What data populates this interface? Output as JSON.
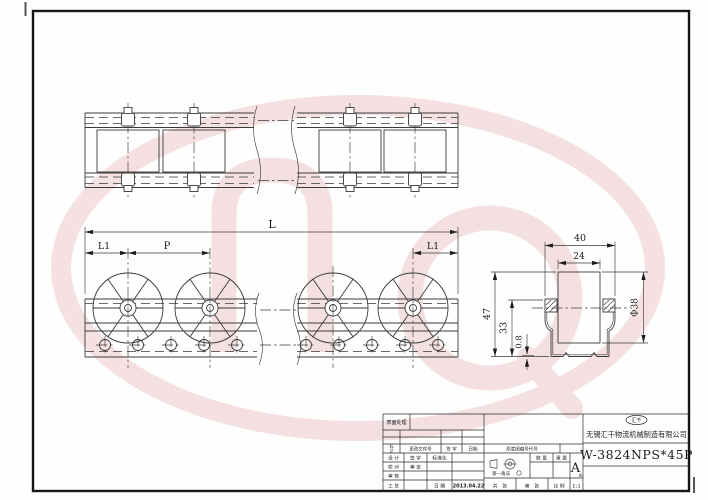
{
  "dims": {
    "L": "L",
    "L1_left": "L1",
    "P": "P",
    "L1_right": "L1",
    "outer_width": "40",
    "inner_width": "24",
    "total_height": "47",
    "rail_height": "33",
    "thickness": "0.8",
    "wheel_dia": "Φ38"
  },
  "title_block": {
    "surface": "表面处理",
    "mark_top": "标",
    "mark_bottom": "记",
    "change_doc": "更改文件号",
    "sign": "签 字",
    "date_h": "日期",
    "r1c1": "设 计",
    "r1c2": "签 字",
    "r1c3": "标准化",
    "r2c1": "校 对",
    "r2c2": "审 定",
    "r3c1": "审 核",
    "r4c1": "工 艺",
    "r4c3": "日 期",
    "date_value": "2013.04.22",
    "base_no": "原底图编号代号",
    "projection": "第一角法",
    "qty": "数 量",
    "weight": "重 量",
    "size_letter": "A",
    "size_sub": "张",
    "sheet_total": "共　张",
    "sheet_no": "第　张",
    "scale_label": "比 例",
    "scale_value": "1:1",
    "logo": "汇千",
    "company": "无锡汇千物流机械制造有限公司",
    "part_number": "W-3824NPS*45P"
  },
  "colors": {
    "line": "#3a3a3a",
    "watermark": "#edc9c9",
    "paper": "#fefefe"
  }
}
